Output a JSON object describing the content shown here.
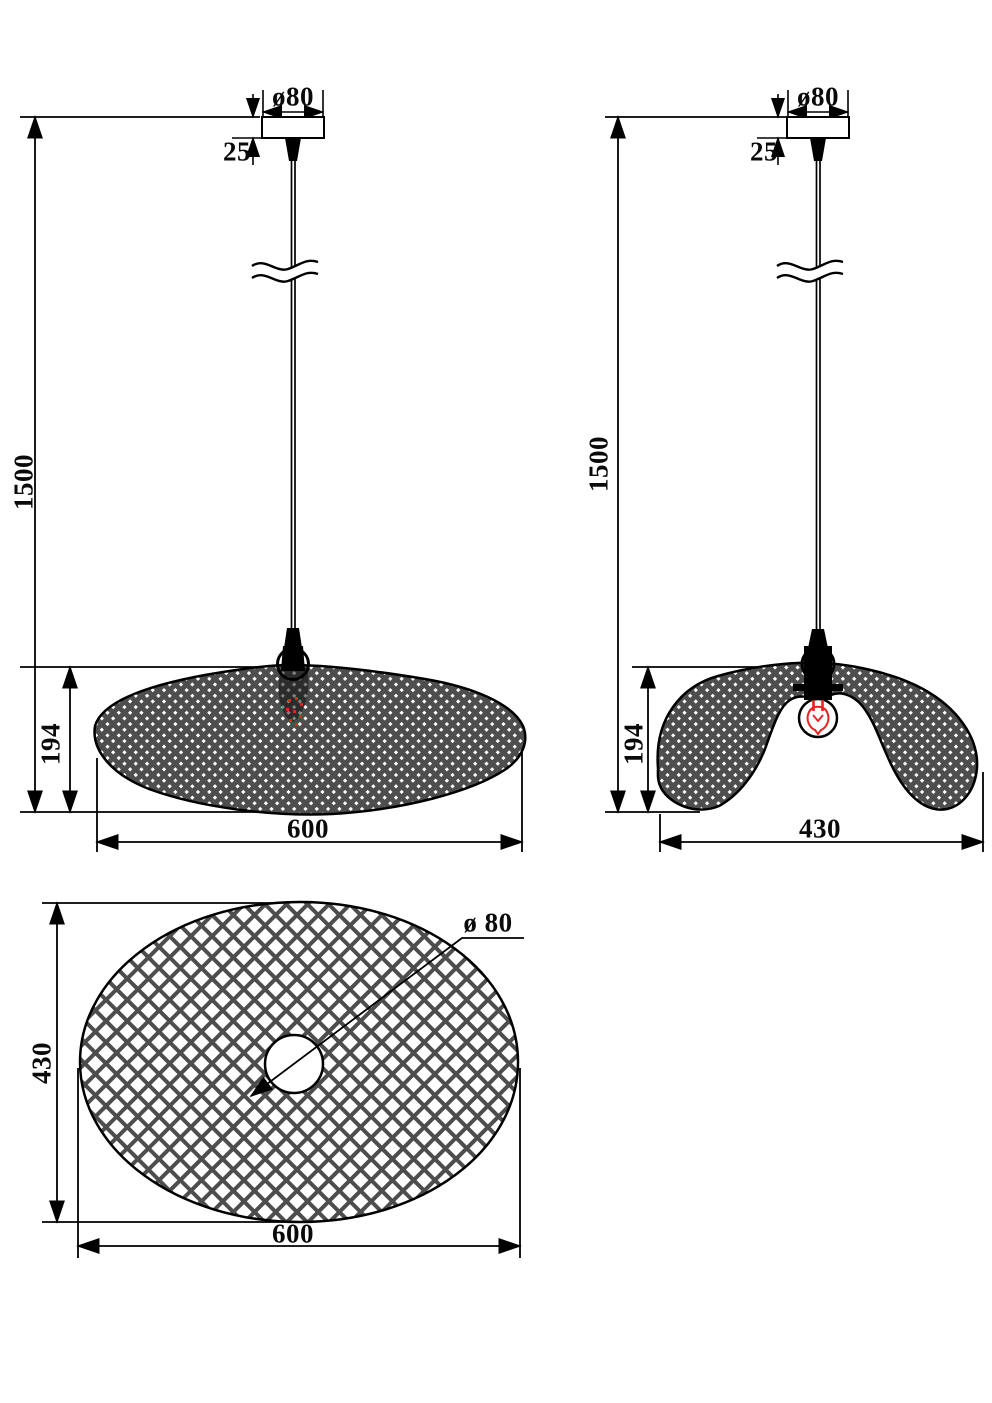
{
  "drawing_title": "Pendant lamp dimension drawing",
  "views": {
    "front": {
      "canopy_diameter": "ø80",
      "canopy_height": "25",
      "suspension_length": "1500",
      "shade_height": "194",
      "shade_width": "600"
    },
    "side": {
      "canopy_diameter": "ø80",
      "canopy_height": "25",
      "suspension_length": "1500",
      "shade_height": "194",
      "shade_width": "430"
    },
    "top": {
      "hole_diameter": "ø 80",
      "shade_depth": "430",
      "shade_width": "600"
    }
  },
  "colors": {
    "line": "#000000",
    "bulb_red": "#e8221f",
    "mesh_dark": "#4e4e4e",
    "lattice_gray": "#4d4d4d",
    "background": "#ffffff"
  }
}
